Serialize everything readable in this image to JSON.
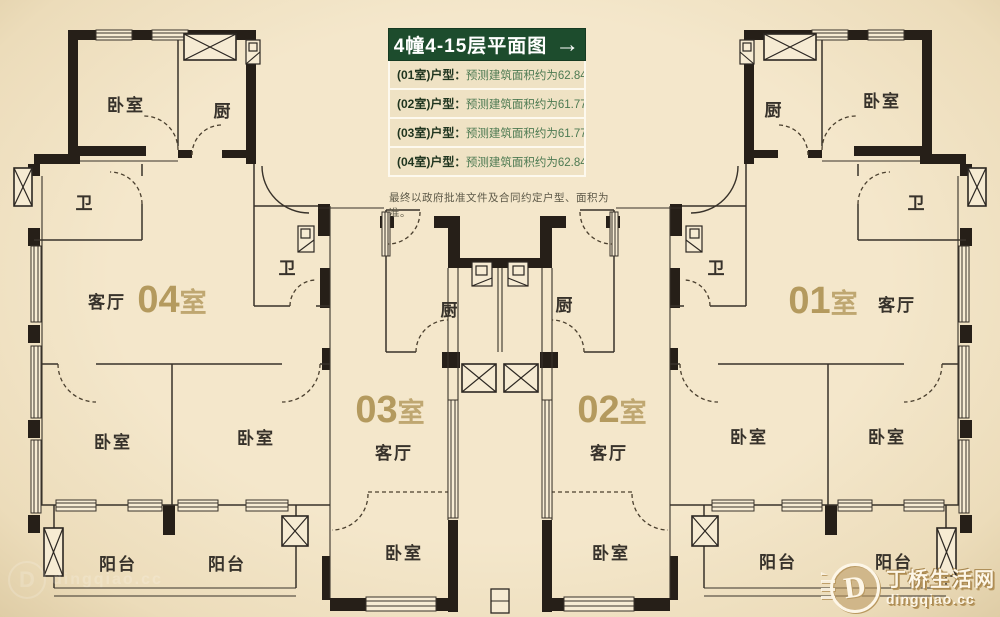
{
  "page": {
    "background": "#f1e3c6",
    "description": "residential floor plan drawing"
  },
  "header": {
    "title": "4幢4-15层平面图",
    "arrow_icon": "→",
    "title_bg": "#1d4c2d",
    "separator": "：",
    "rows": [
      {
        "label": "(01室)户型",
        "value": "预测建筑面积约为62.84M²"
      },
      {
        "label": "(02室)户型",
        "value": "预测建筑面积约为61.77M²"
      },
      {
        "label": "(03室)户型",
        "value": "预测建筑面积约为61.77M²"
      },
      {
        "label": "(04室)户型",
        "value": "预测建筑面积约为62.84M²"
      }
    ],
    "disclaimer": "最终以政府批准文件及合同约定户型、面积为准。"
  },
  "floorplan": {
    "wall_color": "#261f18",
    "line_color": "#38322a",
    "accent_color": "#b49a5e",
    "label_color": "#37322b",
    "unit_labels": [
      {
        "number": "04",
        "suffix": "室",
        "x": 172,
        "y": 312
      },
      {
        "number": "03",
        "suffix": "室",
        "x": 390,
        "y": 422
      },
      {
        "number": "02",
        "suffix": "室",
        "x": 612,
        "y": 422
      },
      {
        "number": "01",
        "suffix": "室",
        "x": 823,
        "y": 313
      }
    ],
    "room_labels": [
      {
        "text": "卧室",
        "x": 126,
        "y": 111
      },
      {
        "text": "厨",
        "x": 223,
        "y": 117
      },
      {
        "text": "卫",
        "x": 85,
        "y": 209
      },
      {
        "text": "客厅",
        "x": 107,
        "y": 308
      },
      {
        "text": "卧室",
        "x": 113,
        "y": 448
      },
      {
        "text": "卧室",
        "x": 256,
        "y": 444
      },
      {
        "text": "阳台",
        "x": 118,
        "y": 570
      },
      {
        "text": "阳台",
        "x": 227,
        "y": 570
      },
      {
        "text": "卫",
        "x": 288,
        "y": 274
      },
      {
        "text": "厨",
        "x": 450,
        "y": 316
      },
      {
        "text": "客厅",
        "x": 394,
        "y": 459
      },
      {
        "text": "卧室",
        "x": 404,
        "y": 559
      },
      {
        "text": "厨",
        "x": 565,
        "y": 311
      },
      {
        "text": "卫",
        "x": 717,
        "y": 274
      },
      {
        "text": "客厅",
        "x": 609,
        "y": 459
      },
      {
        "text": "卧室",
        "x": 611,
        "y": 559
      },
      {
        "text": "厨",
        "x": 774,
        "y": 116
      },
      {
        "text": "卧室",
        "x": 882,
        "y": 107
      },
      {
        "text": "卫",
        "x": 917,
        "y": 209
      },
      {
        "text": "客厅",
        "x": 897,
        "y": 311
      },
      {
        "text": "卧室",
        "x": 749,
        "y": 443
      },
      {
        "text": "卧室",
        "x": 887,
        "y": 443
      },
      {
        "text": "阳台",
        "x": 778,
        "y": 568
      },
      {
        "text": "阳台",
        "x": 894,
        "y": 568
      }
    ]
  },
  "watermark": {
    "site_name": "丁桥生活网",
    "site_url": "dingqiao.cc",
    "logo_letter": "D"
  }
}
